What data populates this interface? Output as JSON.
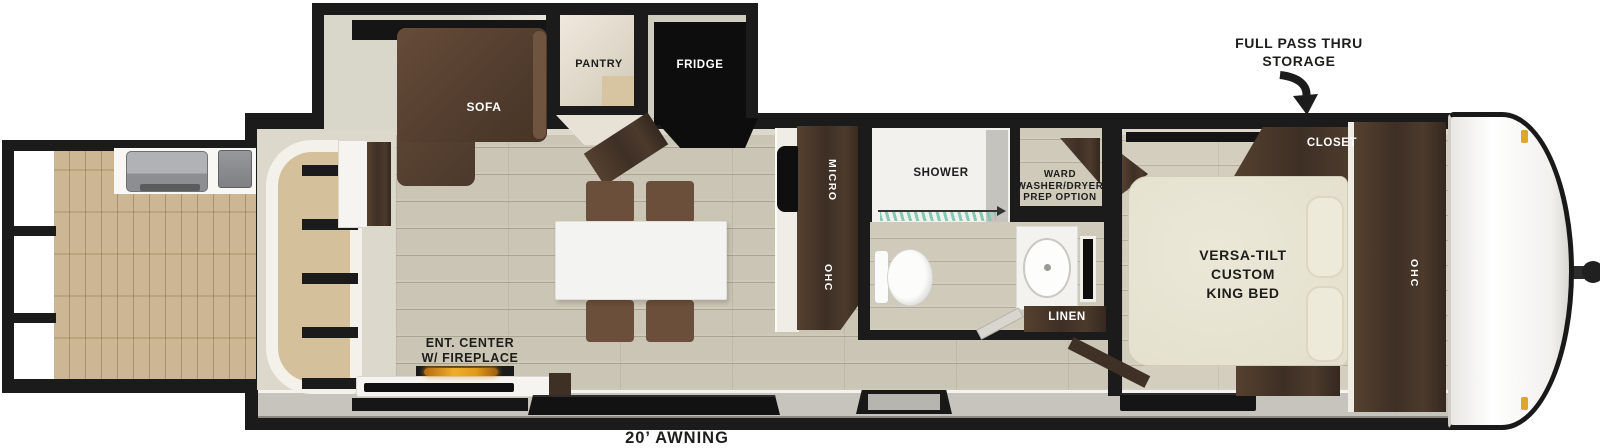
{
  "labels": {
    "storage_line1": "FULL PASS THRU",
    "storage_line2": "STORAGE",
    "closet": "CLOSET",
    "sofa": "SOFA",
    "pantry": "PANTRY",
    "fridge": "FRIDGE",
    "micro": "MICRO",
    "kitchen_ohc": "OHC",
    "shower": "SHOWER",
    "ward_line1": "WARD",
    "ward_line2": "WASHER/DRYER",
    "ward_line3": "PREP OPTION",
    "linen": "LINEN",
    "bed_line1": "VERSA-TILT",
    "bed_line2": "CUSTOM",
    "bed_line3": "KING BED",
    "bedroom_ohc": "OHC",
    "ent_center_line1": "ENT. CENTER",
    "ent_center_line2": "W/ FIREPLACE",
    "awning": "20’ AWNING"
  },
  "colors": {
    "wall": "#1b1b1b",
    "lining": "#dcd8cb",
    "floor_main": "#cac5b4",
    "floor_bedroom": "#d3cebe",
    "deck_wood": "#c9b18c",
    "cabinet_dark": "#4a382d",
    "sofa_brown": "#5d4636",
    "chair_brown": "#6b4f3b",
    "bed_cream": "#e9e5d3",
    "table_white": "#f3f3f1",
    "fireplace_flame": "#e29a1a",
    "shower_curtain": "#7ec8b4",
    "awning_band": "#c6c4bd",
    "marker_light": "#dca62f"
  }
}
